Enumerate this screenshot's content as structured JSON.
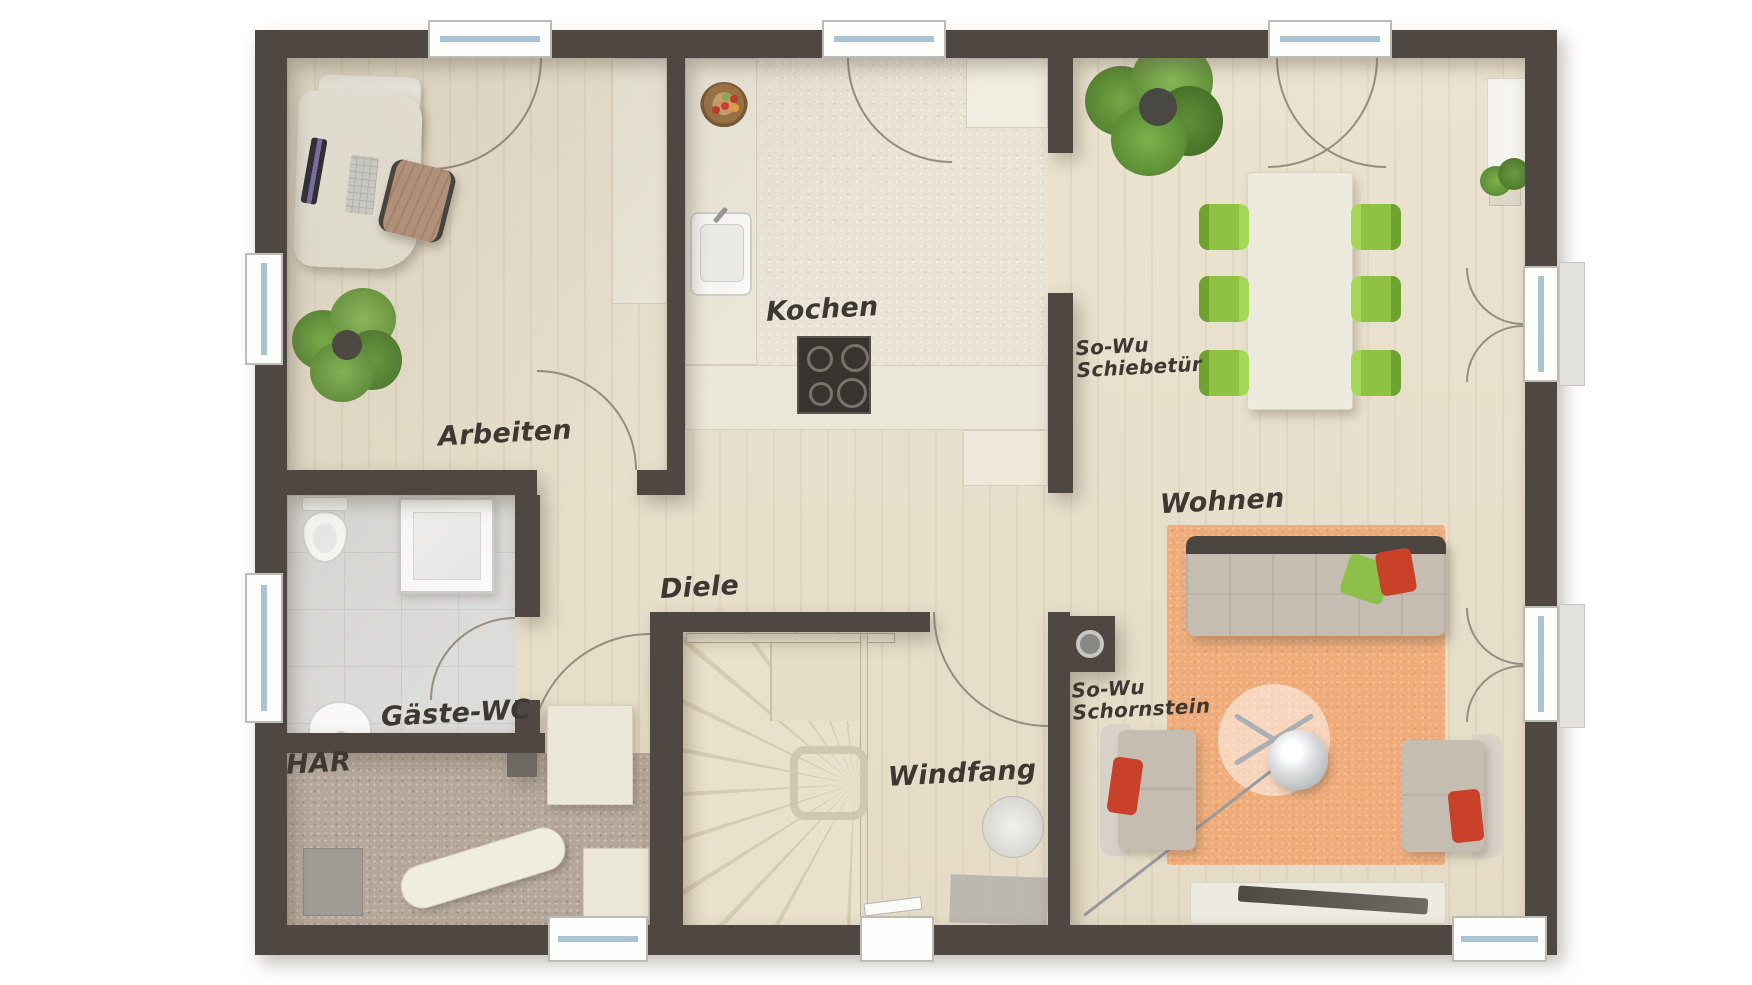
{
  "plan": {
    "type": "floor-plan",
    "rooms": [
      {
        "id": "arbeiten",
        "label": "Arbeiten"
      },
      {
        "id": "kochen",
        "label": "Kochen"
      },
      {
        "id": "diele",
        "label": "Diele"
      },
      {
        "id": "gaeste-wc",
        "label": "Gäste-WC"
      },
      {
        "id": "har",
        "label": "HAR"
      },
      {
        "id": "windfang",
        "label": "Windfang"
      },
      {
        "id": "wohnen",
        "label": "Wohnen"
      }
    ],
    "annotations": [
      {
        "id": "schiebetuer",
        "label": "So-Wu\nSchiebetür"
      },
      {
        "id": "schornstein",
        "label": "So-Wu\nSchornstein"
      }
    ],
    "colors": {
      "wall": "#4f4842",
      "wood_floor": "#e8e0cd",
      "tile_floor": "#dcdcda",
      "utility_floor": "#b5a89b",
      "rug": "#f0ad7b",
      "dining_chair_green": "#95c84a",
      "pillow_red": "#c94129",
      "pillow_green": "#8cc04b",
      "plant_green": "#7fae4f",
      "sofa": "#c6bdb2"
    },
    "furniture_icons": [
      "desk",
      "office-chair",
      "monitor",
      "keyboard",
      "plant",
      "wardrobe",
      "kitchen-sink",
      "stove",
      "fridge",
      "fruit-bowl",
      "counter",
      "sliding-door-panel",
      "dining-table",
      "dining-chair",
      "sofa",
      "armchair",
      "coffee-table",
      "arc-lamp",
      "lowboard",
      "rug",
      "radiator",
      "toilet",
      "shower",
      "washbasin",
      "ironing-board",
      "storage-box",
      "water-heater",
      "cabinet",
      "stairs",
      "handrail",
      "chimney",
      "doormat",
      "entrance-door",
      "window",
      "door-swing"
    ]
  }
}
